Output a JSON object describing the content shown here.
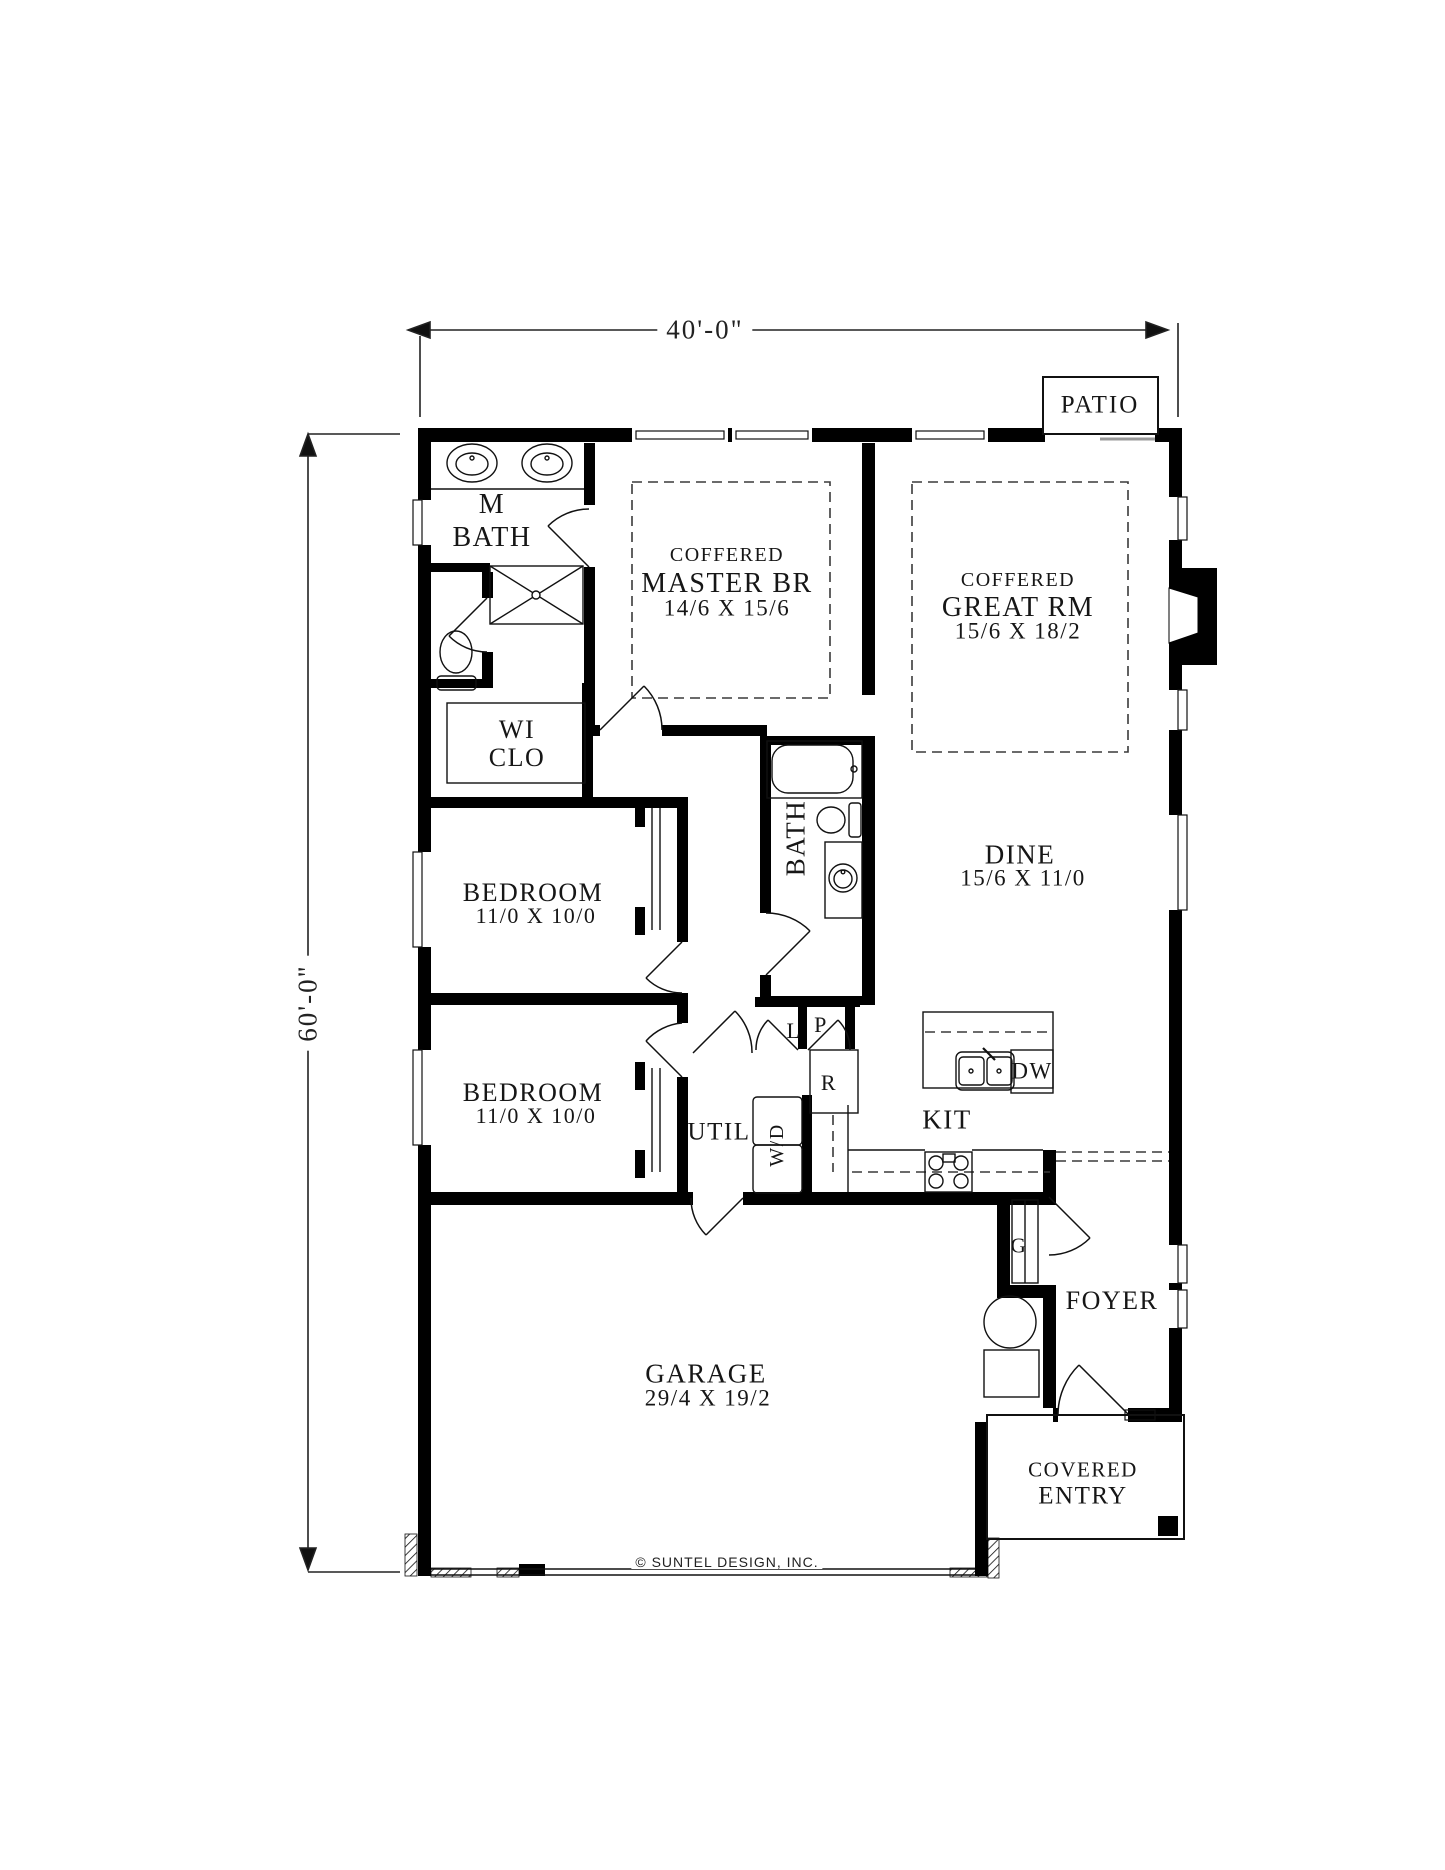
{
  "drawing": {
    "width_label": "40'-0\"",
    "height_label": "60'-0\"",
    "copyright": "© SUNTEL DESIGN, INC."
  },
  "rooms": {
    "patio": "PATIO",
    "m_bath_l1": "M",
    "m_bath_l2": "BATH",
    "master_coffered": "COFFERED",
    "master": "MASTER BR",
    "master_size": "14/6 X 15/6",
    "great_coffered": "COFFERED",
    "great": "GREAT RM",
    "great_size": "15/6 X 18/2",
    "wic_l1": "WI",
    "wic_l2": "CLO",
    "bedroom1": "BEDROOM",
    "bedroom1_size": "11/0 X 10/0",
    "bath": "BATH",
    "dine": "DINE",
    "dine_size": "15/6 X 11/0",
    "bedroom2": "BEDROOM",
    "bedroom2_size": "11/0 X 10/0",
    "util": "UTIL",
    "wd": "W/D",
    "linen": "L",
    "pantry": "P",
    "fridge": "R",
    "kit": "KIT",
    "dw": "DW",
    "coat": "G",
    "foyer": "FOYER",
    "garage": "GARAGE",
    "garage_size": "29/4 X 19/2",
    "entry_l1": "COVERED",
    "entry_l2": "ENTRY"
  }
}
